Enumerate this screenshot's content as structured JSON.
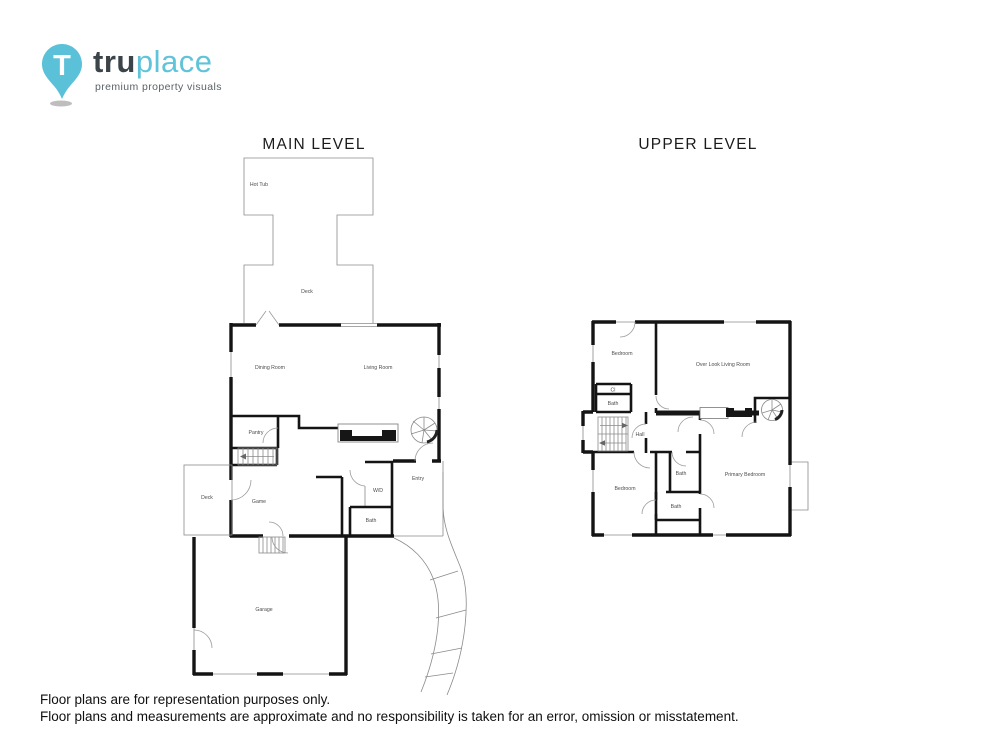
{
  "logo": {
    "brand_bold": "tru",
    "brand_light": "place",
    "tagline": "premium property visuals",
    "pin_letter": "T"
  },
  "colors": {
    "brand_teal": "#5fc3d9",
    "wall_black": "#141414",
    "thin_gray": "#8a8a8a"
  },
  "plans": {
    "main": {
      "title": "MAIN LEVEL",
      "rooms": {
        "hot_tub": "Hot Tub",
        "upper_deck": "Deck",
        "dining_room": "Dining Room",
        "living_room": "Living Room",
        "pantry": "Pantry",
        "side_deck": "Deck",
        "game": "Game",
        "washer_dryer": "W/D",
        "bath": "Bath",
        "entry": "Entry",
        "garage": "Garage"
      }
    },
    "upper": {
      "title": "UPPER LEVEL",
      "rooms": {
        "bedroom_front": "Bedroom",
        "overlook_living_room": "Over Look Living Room",
        "closet": "Cl",
        "bath_top": "Bath",
        "hall": "Hall",
        "bedroom_rear": "Bedroom",
        "bath_mid": "Bath",
        "bath_lower": "Bath",
        "primary_bedroom": "Primary Bedroom"
      }
    }
  },
  "footer": {
    "line1": "Floor plans are for representation purposes only.",
    "line2": "Floor plans and measurements are approximate and no responsibility is taken for an error, omission or misstatement."
  }
}
